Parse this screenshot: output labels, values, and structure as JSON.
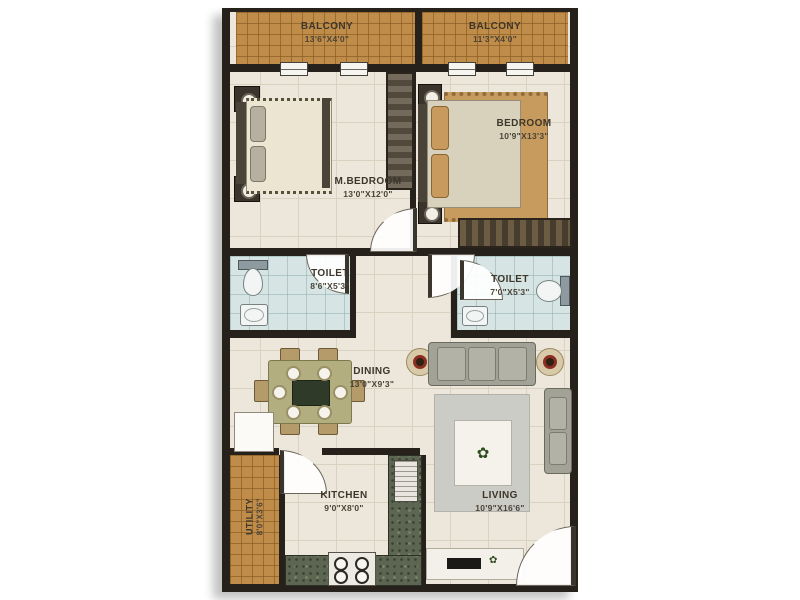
{
  "palette": {
    "background": "#ffffff",
    "wall": "#26211b",
    "floor_tile": "#ece7da",
    "floor_grout": "#d9d2c1",
    "balcony_tile": "#c08c49",
    "toilet_tile": "#d6e4e4",
    "counter_granite": "#5d6652",
    "label_text": "#3d362b",
    "shadow": "#c2c2c2"
  },
  "rooms": {
    "balcony_left": {
      "label": "BALCONY",
      "dims": "13'6\"X4'0\""
    },
    "balcony_right": {
      "label": "BALCONY",
      "dims": "11'3\"X4'0\""
    },
    "m_bedroom": {
      "label": "M.BEDROOM",
      "dims": "13'0\"X12'0\""
    },
    "bedroom": {
      "label": "BEDROOM",
      "dims": "10'9\"X13'3\""
    },
    "toilet_left": {
      "label": "TOILET",
      "dims": "8'6\"X5'3\""
    },
    "toilet_right": {
      "label": "TOILET",
      "dims": "7'0\"X5'3\""
    },
    "dining": {
      "label": "DINING",
      "dims": "13'0\"X9'3\""
    },
    "living": {
      "label": "LIVING",
      "dims": "10'9\"X16'6\""
    },
    "kitchen": {
      "label": "KITCHEN",
      "dims": "9'0\"X8'0\""
    },
    "utility": {
      "label": "UTILITY",
      "dims": "8'0\"X3'6\""
    }
  }
}
